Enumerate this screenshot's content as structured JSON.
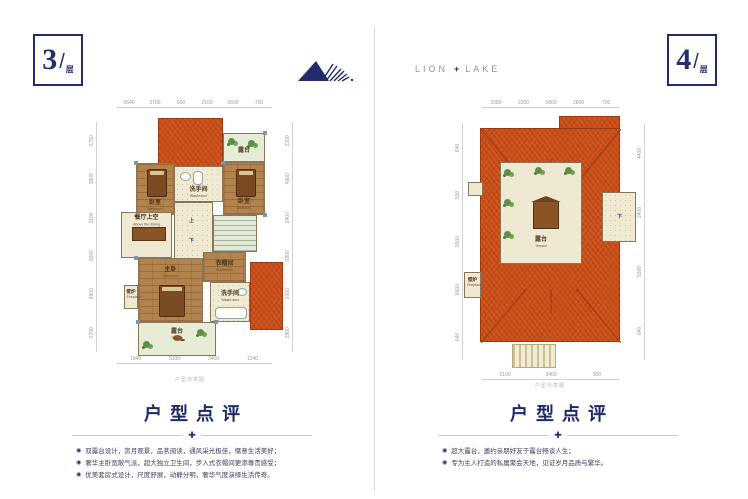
{
  "badges": {
    "left": {
      "num": "3",
      "slash": "/",
      "unit": "层"
    },
    "right": {
      "num": "4",
      "slash": "/",
      "unit": "层"
    }
  },
  "brand": {
    "word1": "LION",
    "plus": "+",
    "word2": "LAKE"
  },
  "plan3": {
    "note": "户型示意图",
    "dims": {
      "top": [
        "5640",
        "2700",
        "600",
        "2100",
        "3600",
        "700"
      ],
      "bottom": [
        "1940",
        "5100",
        "3400",
        "1240"
      ],
      "left": [
        "2750",
        "3800",
        "1100",
        "3600",
        "4800",
        "2700"
      ],
      "right": [
        "2200",
        "4900",
        "2400",
        "2800",
        "2000",
        "2900"
      ]
    },
    "rooms": {
      "terrace_top": {
        "zh": "露台",
        "en": "Terrace"
      },
      "bedroom_left": {
        "zh": "卧室",
        "en": "Bedroom"
      },
      "bedroom_right": {
        "zh": "卧室",
        "en": "Bedroom"
      },
      "washroom_top": {
        "zh": "洗手间",
        "en": "Washroom"
      },
      "dining_void": {
        "zh": "餐厅上空",
        "en": "Above the dining room"
      },
      "cloakroom": {
        "zh": "衣帽间",
        "en": "Cloakroom"
      },
      "master": {
        "zh": "主卧",
        "en": "Bedroom"
      },
      "bathroom": {
        "zh": "洗手间",
        "en": "Washroom"
      },
      "terrace_bottom": {
        "zh": "露台",
        "en": "Terrace"
      },
      "fireplace": {
        "zh": "壁炉",
        "en": "Fireplace"
      },
      "stairs_up": "上",
      "stairs_down": "下"
    }
  },
  "plan4": {
    "note": "户型示意图",
    "dims": {
      "top": [
        "3300",
        "2200",
        "5800",
        "2800",
        "700"
      ],
      "bottom": [
        "5100",
        "3400",
        "900"
      ],
      "left": [
        "640",
        "500",
        "3900",
        "6600",
        "640"
      ],
      "right": [
        "4400",
        "2400",
        "5300",
        "640"
      ]
    },
    "rooms": {
      "terrace": {
        "zh": "露台",
        "en": "Terrace"
      },
      "fireplace": {
        "zh": "壁炉",
        "en": "Fireplace"
      },
      "stairs_down": "下"
    }
  },
  "review3": {
    "title": "户型点评",
    "separator_icon": "✚",
    "bullet_icon": "◉",
    "items": [
      "双露台设计，赏月观景，品茗阅读，通风采光极佳，惬意生活美好；",
      "奢华主卧宽敞气派，超大独立卫生间，步入式衣帽间更添尊贵感受；",
      "优美套房式设计，尺度舒展，动静分明，奢华气度演绎生活传奇。"
    ]
  },
  "review4": {
    "title": "户型点评",
    "separator_icon": "✚",
    "bullet_icon": "◉",
    "items": [
      "超大露台，邀约亲朋好友于露台畅谈人生；",
      "专为主人打造的私属聚会天地，见证岁月品质与繁华。"
    ]
  },
  "colors": {
    "navy": "#232d6b",
    "roof": "#d0551f",
    "wood": "#b3834e",
    "cream": "#f0ead3",
    "dim_gray": "#9a9a9a"
  }
}
